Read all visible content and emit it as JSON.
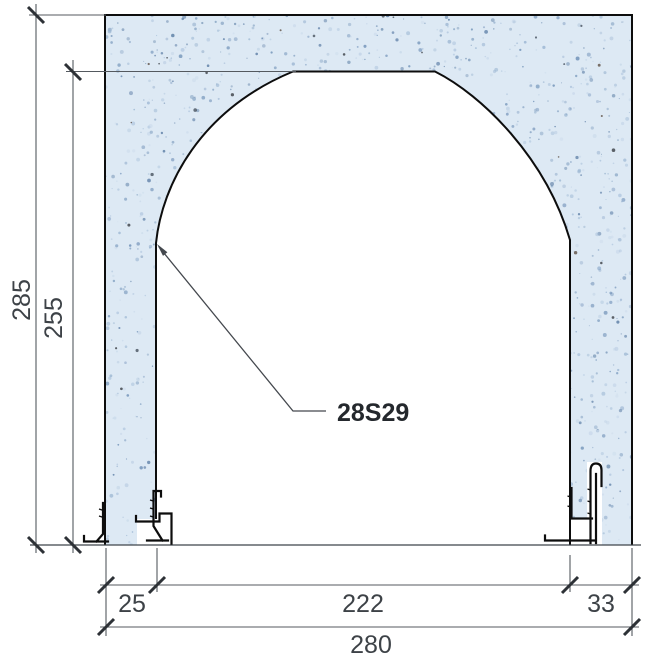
{
  "drawing": {
    "type": "section-detail-arched-opening",
    "label": {
      "text": "28S29"
    },
    "dimensions": {
      "overall_height": "285",
      "opening_height": "255",
      "left_jamb_width": "25",
      "opening_width": "222",
      "right_jamb_width": "33",
      "overall_width": "280"
    },
    "colors": {
      "background": "#ffffff",
      "concrete_base": "#dde9f4",
      "speckles": [
        "#c9d9ea",
        "#b4c9e0",
        "#9db7d3",
        "#86a3c4",
        "#7293b8",
        "#5e7fa6"
      ],
      "dark_speckles": [
        "#3c4754",
        "#2e3238",
        "#554639"
      ],
      "outline": "#0d0d0d",
      "dimension_line": "#54595f",
      "tick": "#2d3136",
      "dimension_text": "#3d4247",
      "label_text": "#24282d"
    }
  }
}
